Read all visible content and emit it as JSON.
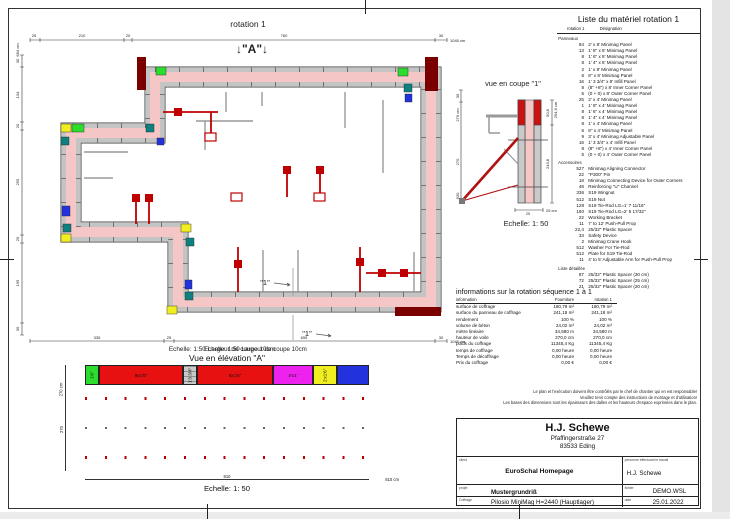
{
  "plan": {
    "title": "rotation 1",
    "marker_a": "↓\"A\"↓",
    "marker_1": "\"1\"",
    "scale_note": "Echelle: 1:50  Largeur de coupe 10cm",
    "dims": {
      "top": {
        "segments": [
          "25",
          "210",
          "20",
          "760",
          "30"
        ],
        "total": "1045 cm"
      },
      "left": {
        "segments": [
          "30",
          "134",
          "20",
          "255",
          "20",
          "195",
          "30"
        ],
        "total": "684 cm"
      },
      "bottom": {
        "segments": [
          "335",
          "25",
          "655",
          "30"
        ],
        "total": "1045 cm"
      }
    }
  },
  "section": {
    "title": "vue en coupe \"1\"",
    "scale": "Echelle: 1: 50",
    "dims": {
      "left_top": "30",
      "left_total": "270 cm",
      "left_mid": "270",
      "left_bottom": "630",
      "right_total": "294,6 cm",
      "right_top": "50,8",
      "right_mid": "243,8",
      "width": "25",
      "width_total": "25 cm"
    }
  },
  "elevation": {
    "title": "Vue en élévation \"A\"",
    "scale": "Echelle: 1: 50",
    "dim_mid": "810",
    "dim_total": "810 cm",
    "left_dim": "270",
    "left_total": "270 cm",
    "topband": [
      {
        "css": "width:14px;background:#2ddd2d",
        "cls": "ecell vlab",
        "label": "1'6\""
      },
      {
        "css": "width:84px;background:#e81111",
        "cls": "ecell",
        "label": "9x1'6\""
      },
      {
        "css": "width:14px;background:#c9c9c9",
        "cls": "ecell hatch vlab",
        "label": "1'3 3/4\""
      },
      {
        "css": "width:76px;background:#e81111",
        "cls": "ecell",
        "label": "8x1'6\""
      },
      {
        "css": "width:40px;background:#ee22ee",
        "cls": "ecell",
        "label": "4'x1'"
      },
      {
        "css": "width:24px;background:#f0ee20",
        "cls": "ecell vlab",
        "label": "2'x1'6\""
      },
      {
        "css": "width:32px;background:#2233dd",
        "cls": "ecell",
        "label": ""
      }
    ],
    "columns": [
      {
        "css": "width:22px;background:#e81111",
        "cls": "ecell vlab",
        "label": "1'6\"x8'"
      },
      {
        "css": "width:19px;background:#c9c9c9",
        "cls": "ecell vlab",
        "label": "2'x8'"
      },
      {
        "css": "width:13px;background:#c9c9c9",
        "cls": "ecell hatch vlab",
        "label": "1'3 3/4\"x8'"
      },
      {
        "css": "width:20px;background:#c9c9c9",
        "cls": "ecell vlab",
        "label": "2'x8'"
      },
      {
        "css": "width:20px;background:#c9c9c9",
        "cls": "ecell vlab",
        "label": "2'x8'"
      },
      {
        "css": "width:20px;background:#c9c9c9",
        "cls": "ecell vlab",
        "label": "2'x8'"
      },
      {
        "css": "width:20px;background:#c9c9c9",
        "cls": "ecell vlab",
        "label": "2'x8'"
      },
      {
        "css": "width:20px;background:#c9c9c9",
        "cls": "ecell vlab",
        "label": "2'x8'"
      },
      {
        "css": "width:20px;background:#c9c9c9",
        "cls": "ecell vlab",
        "label": "2'x8'"
      },
      {
        "css": "width:20px;background:#c9c9c9",
        "cls": "ecell vlab",
        "label": "2'x8'"
      },
      {
        "css": "width:20px;background:#c9c9c9",
        "cls": "ecell vlab",
        "label": "2'x8'"
      },
      {
        "css": "width:20px;background:#c9c9c9",
        "cls": "ecell vlab",
        "label": "2'x8'"
      },
      {
        "css": "width:20px;background:#c9c9c9",
        "cls": "ecell vlab",
        "label": "2'x8'"
      },
      {
        "css": "width:15px;background:#2ddd2d",
        "cls": "ecell vlab",
        "label": "1'4\"x8'"
      },
      {
        "css": "width:15px;background:#2ddd2d",
        "cls": "ecell vlab",
        "label": "1'4\"x8'"
      }
    ]
  },
  "materials": {
    "title": "Liste du matériel  rotation 1",
    "col_rotation": "rotation 1",
    "col_designation": "Désignation",
    "rows": [
      {
        "cls": "mat-row mat-sec",
        "q": "",
        "d": "Panneaux"
      },
      {
        "cls": "mat-row",
        "q": "84",
        "d": "2' x 8' Minimag Panel"
      },
      {
        "cls": "mat-row",
        "q": "13",
        "d": "1' 8\" x 8' Minimag Panel"
      },
      {
        "cls": "mat-row",
        "q": "8",
        "d": "1' 6\" x 8' Minimag Panel"
      },
      {
        "cls": "mat-row",
        "q": "8",
        "d": "1' 4\" x 8' Minimag Panel"
      },
      {
        "cls": "mat-row",
        "q": "2",
        "d": "1' x 8' Minimag Panel"
      },
      {
        "cls": "mat-row",
        "q": "6",
        "d": "8\" x 8' Minimag Panel"
      },
      {
        "cls": "mat-row",
        "q": "16",
        "d": "1' 3 3/4\" x 8' Infill Panel"
      },
      {
        "cls": "mat-row",
        "q": "8",
        "d": "(8\" +8\") x 8' Inner Corner Panel"
      },
      {
        "cls": "mat-row",
        "q": "5",
        "d": "(0 + 0) x 8' Outer Corner Panel"
      },
      {
        "cls": "mat-row",
        "q": "25",
        "d": "2' x 4' Minimag Panel"
      },
      {
        "cls": "mat-row",
        "q": "1",
        "d": "1' 8\" x 4' Minimag Panel"
      },
      {
        "cls": "mat-row",
        "q": "8",
        "d": "1' 6\" x 4' Minimag Panel"
      },
      {
        "cls": "mat-row",
        "q": "8",
        "d": "1' 4\" x 4' Minimag Panel"
      },
      {
        "cls": "mat-row",
        "q": "8",
        "d": "1' x 4' Minimag Panel"
      },
      {
        "cls": "mat-row",
        "q": "6",
        "d": "8\" x 4' Minimag Panel"
      },
      {
        "cls": "mat-row",
        "q": "9",
        "d": "3' x 4' Minimag Adjustable Panel"
      },
      {
        "cls": "mat-row",
        "q": "16",
        "d": "1' 3 3/4\" x 4' Infill Panel"
      },
      {
        "cls": "mat-row",
        "q": "8",
        "d": "(8\" +8\") x 4' Inner Corner Panel"
      },
      {
        "cls": "mat-row",
        "q": "5",
        "d": "(0 + 0) x 4' Outer Corner Panel"
      },
      {
        "cls": "mat-row mat-sec",
        "q": "",
        "d": "Accessoires"
      },
      {
        "cls": "mat-row",
        "q": "527",
        "d": "Minimag Aligning Connector"
      },
      {
        "cls": "mat-row",
        "q": "22",
        "d": "\"P300\" Pin"
      },
      {
        "cls": "mat-row",
        "q": "18",
        "d": "Minimag Connecting Device for Outer Corners"
      },
      {
        "cls": "mat-row",
        "q": "48",
        "d": "Reinforcing \"U\" Channel"
      },
      {
        "cls": "mat-row",
        "q": "336",
        "d": "S19 Wingnut"
      },
      {
        "cls": "mat-row",
        "q": "512",
        "d": "S19 Nut"
      },
      {
        "cls": "mat-row",
        "q": "128",
        "d": "S19 Tie-Rod LG=1' 7 11/16\""
      },
      {
        "cls": "mat-row",
        "q": "160",
        "d": "S19 Tie-Rod LG=2' 5 17/32\""
      },
      {
        "cls": "mat-row",
        "q": "22",
        "d": "Working Bracket"
      },
      {
        "cls": "mat-row",
        "q": "11",
        "d": "7' to 12' Push-Pull Prop"
      },
      {
        "cls": "mat-row",
        "q": "22,4",
        "d": "25/32\" Plastic Spacer"
      },
      {
        "cls": "mat-row",
        "q": "33",
        "d": "Safety Device"
      },
      {
        "cls": "mat-row",
        "q": "2",
        "d": "Minimag Crane Hook"
      },
      {
        "cls": "mat-row",
        "q": "512",
        "d": "Washer For Tie-Rod"
      },
      {
        "cls": "mat-row",
        "q": "512",
        "d": "Plate for S19 Tie-Rod"
      },
      {
        "cls": "mat-row",
        "q": "11",
        "d": "4' to 5' Adjustable Arm for Push-Pull Prop"
      },
      {
        "cls": "mat-row mat-sec",
        "q": "",
        "d": "Liste détaillée"
      },
      {
        "cls": "mat-row",
        "q": "87",
        "d": "25/32\" Plastic Spacer (30 cm)"
      },
      {
        "cls": "mat-row",
        "q": "72",
        "d": "25/32\" Plastic Spacer (25 cm)"
      },
      {
        "cls": "mat-row",
        "q": "21",
        "d": "25/32\" Plastic Spacer (20 cm)"
      }
    ]
  },
  "info": {
    "title": "informations sur la rotation  séquence 1 à 1",
    "h_label": "information",
    "h_four": "Fourniture",
    "h_rot": "rotation 1",
    "rows": [
      {
        "l": "surface de coffrage",
        "a": "180,79 m²",
        "b": "180,79 m²"
      },
      {
        "l": "surface du panneau de coffrage",
        "a": "241,18 m²",
        "b": "241,18 m²"
      },
      {
        "l": "rendement",
        "a": "100 %",
        "b": "100 %"
      },
      {
        "l": "volume de béton",
        "a": "24,02 m³",
        "b": "24,02 m³"
      },
      {
        "l": "mètre linéaire",
        "a": "34,580 m",
        "b": "34,580 m"
      },
      {
        "l": "hauteur de voile",
        "a": "270,0 cm",
        "b": "270,0 cm"
      },
      {
        "l": "poids du coffrage",
        "a": "11345,4 Kg",
        "b": "11345,4 Kg"
      },
      {
        "l": "temps de coffrage",
        "a": "0,00 heure",
        "b": "0,00 heure"
      },
      {
        "l": "Temps de décoffrage",
        "a": "0,00 heure",
        "b": "0,00 heure"
      },
      {
        "l": "Prix du coffrage",
        "a": "0,00 €",
        "b": "0,00 €"
      }
    ]
  },
  "disclaimer": {
    "line1": "Le plan et l'exécution doivent être contrôlés par le chef de chantier qui en est responsable!",
    "line2": "Veuillez tenir compte des instructions de montage et d'utilisation!",
    "line3": "Les bases des dimensions sont les épaisseurs des dalles et les hauteurs d'espace exprimées dans le plan."
  },
  "titleblock": {
    "name": "H.J. Schewe",
    "street": "Pfaffingerstraße 27",
    "city": "83533 Eding",
    "client_label": "client",
    "client": "EuroSchal Homepage",
    "worker_label": "personne effectuant le travail",
    "worker": "H.J. Schewe",
    "project_label": "projet",
    "project": "Mustergrundriß",
    "file_label": "fichier",
    "file": "DEMO.WSL",
    "formwork_label": "Coffrage",
    "formwork": "Pilosio MiniMag H=2440 (Hauptlager)",
    "date_label": "date",
    "date": "25.01.2022"
  }
}
